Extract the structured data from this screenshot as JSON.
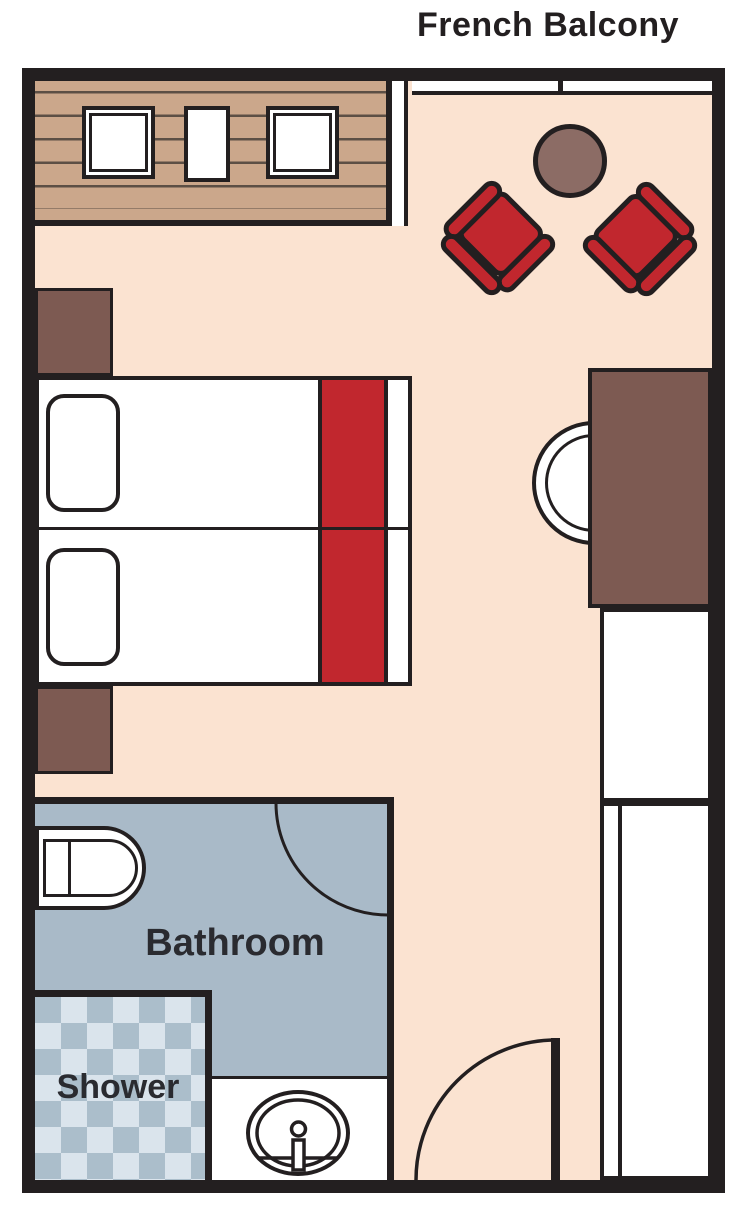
{
  "title": "French Balcony",
  "rooms": {
    "bathroom_label": "Bathroom",
    "shower_label": "Shower"
  },
  "icons": {
    "toilet": "toilet-icon",
    "sink": "sink-icon",
    "door_swing": "door-swing-arc-icon"
  },
  "colors": {
    "floor": "#FBE3D1",
    "wall": "#231F20",
    "wood": "#CBA78B",
    "plank": "#5C4F45",
    "brown": "#7D5A52",
    "table": "#8C6C65",
    "red": "#C1272E",
    "bath": "#A9BAC8",
    "check-light": "#DAE4EC",
    "check-dark": "#ABBECB",
    "white": "#FFFFFF",
    "text": "#2A2B30"
  }
}
